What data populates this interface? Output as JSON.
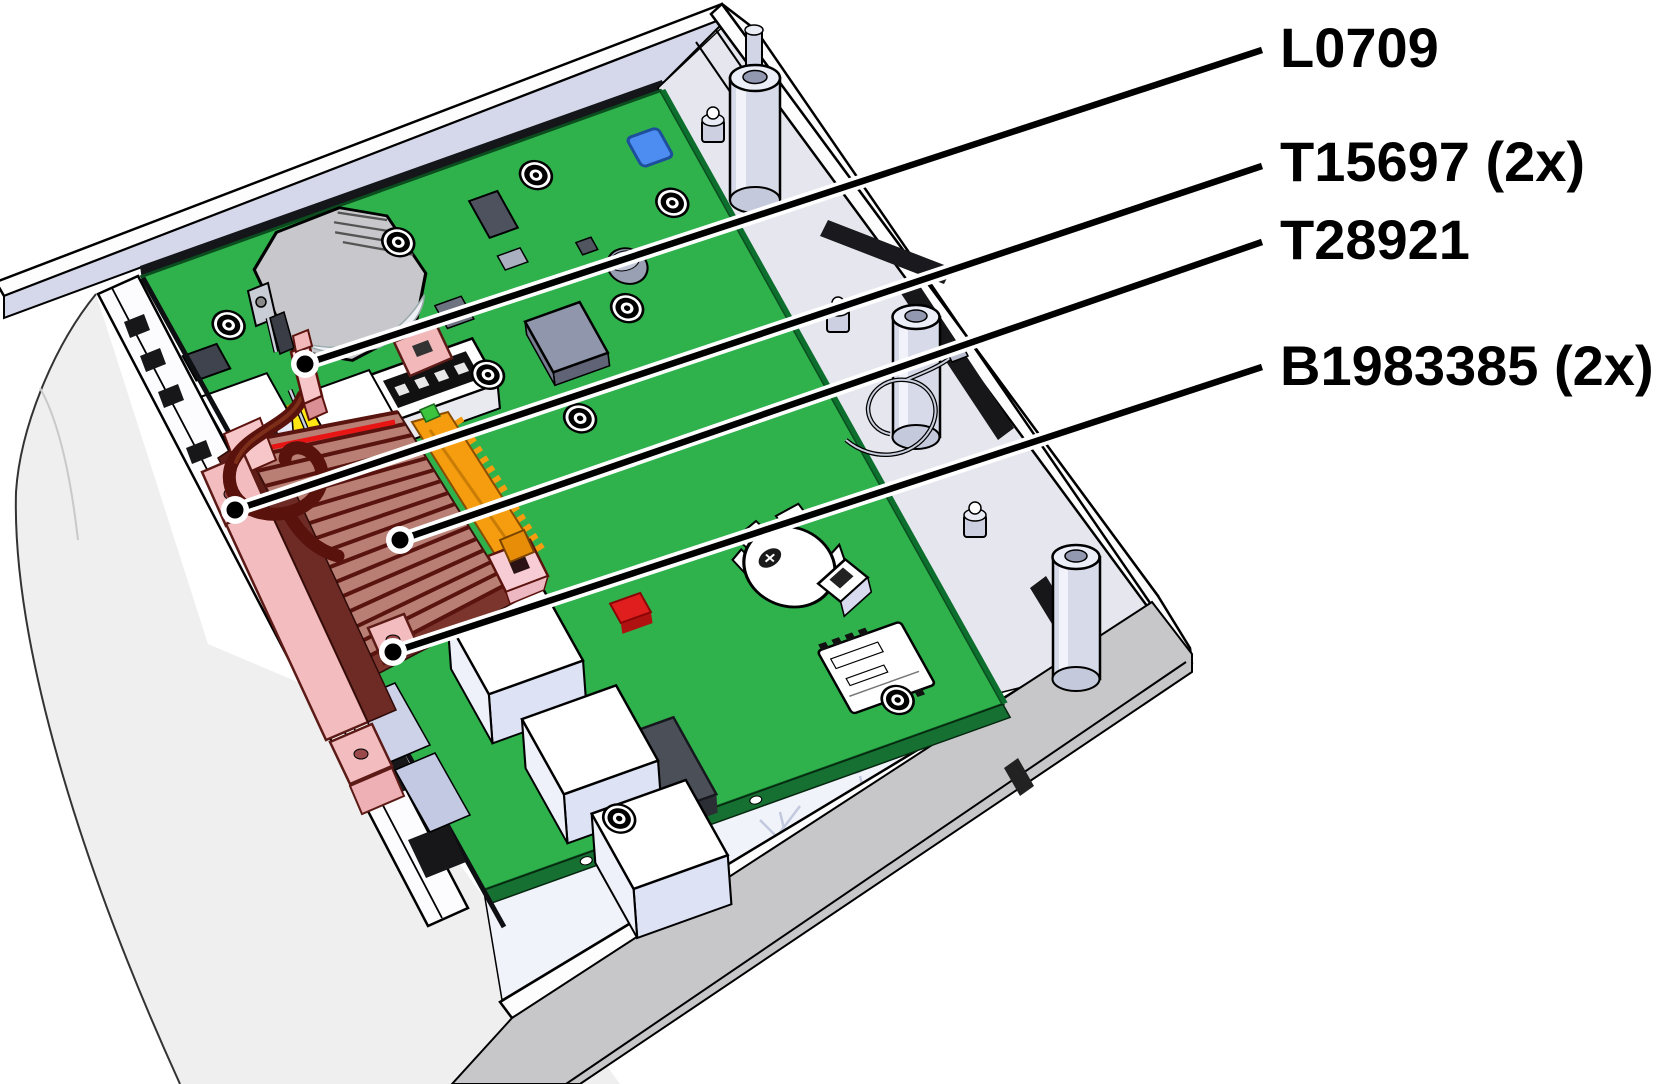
{
  "diagram": {
    "type": "technical-illustration",
    "subject": "opened device chassis with mainboard",
    "background_color": "#ffffff",
    "outline_color": "#000000",
    "colors": {
      "pcb": "#2fb14c",
      "pcb_edge": "#157032",
      "case_white": "#fcfcfe",
      "case_interior": "#d4d8ea",
      "case_band": "#c7c7c9",
      "heatsink_fins": "#b97f74",
      "heatsink_rail": "#f59d0f",
      "clamp_pink": "#f3bcbe",
      "capacitor_yellow": "#ffe714",
      "component_blue": "#4d8df2",
      "component_red": "#e11e1e",
      "wire_maroon": "#5a120d"
    },
    "callouts": [
      {
        "label": "L0709",
        "target": "cable-end-sleeve"
      },
      {
        "label": "T15697 (2x)",
        "target": "clamp-block"
      },
      {
        "label": "T28921",
        "target": "heatsink-fin-array"
      },
      {
        "label": "B1983385 (2x)",
        "target": "heatsink-foot-bracket"
      }
    ]
  }
}
